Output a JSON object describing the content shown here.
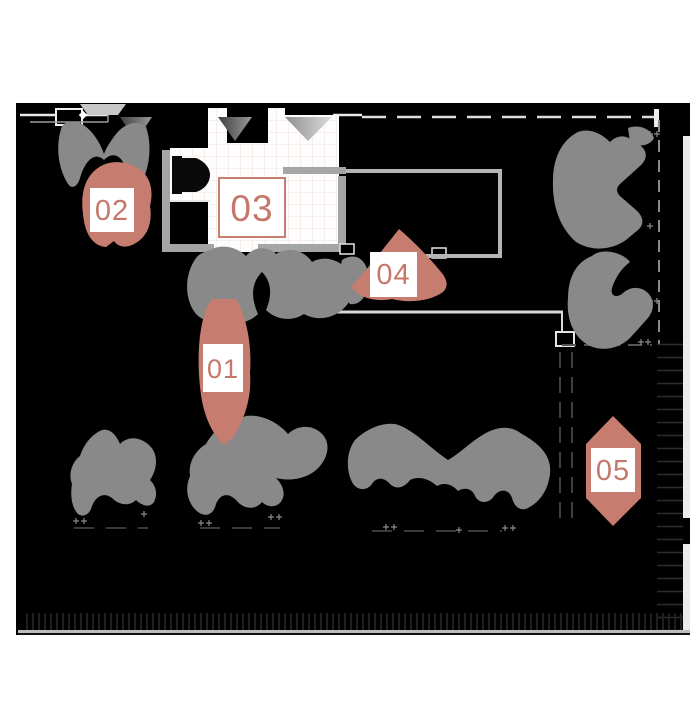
{
  "floor_plan": {
    "markers": [
      {
        "id": "marker-01",
        "label": "01"
      },
      {
        "id": "marker-02",
        "label": "02"
      },
      {
        "id": "marker-03",
        "label": "03"
      },
      {
        "id": "marker-04",
        "label": "04"
      },
      {
        "id": "marker-05",
        "label": "05"
      }
    ],
    "colors": {
      "accent": "#c67c6e",
      "accent_text": "#c4786a",
      "furniture": "#898989",
      "plan_background": "#000000",
      "page_background": "#ffffff",
      "wall_light": "#d9d9d9",
      "wall_gray": "#a5a5a5",
      "tile_line": "#f2e6df"
    }
  }
}
